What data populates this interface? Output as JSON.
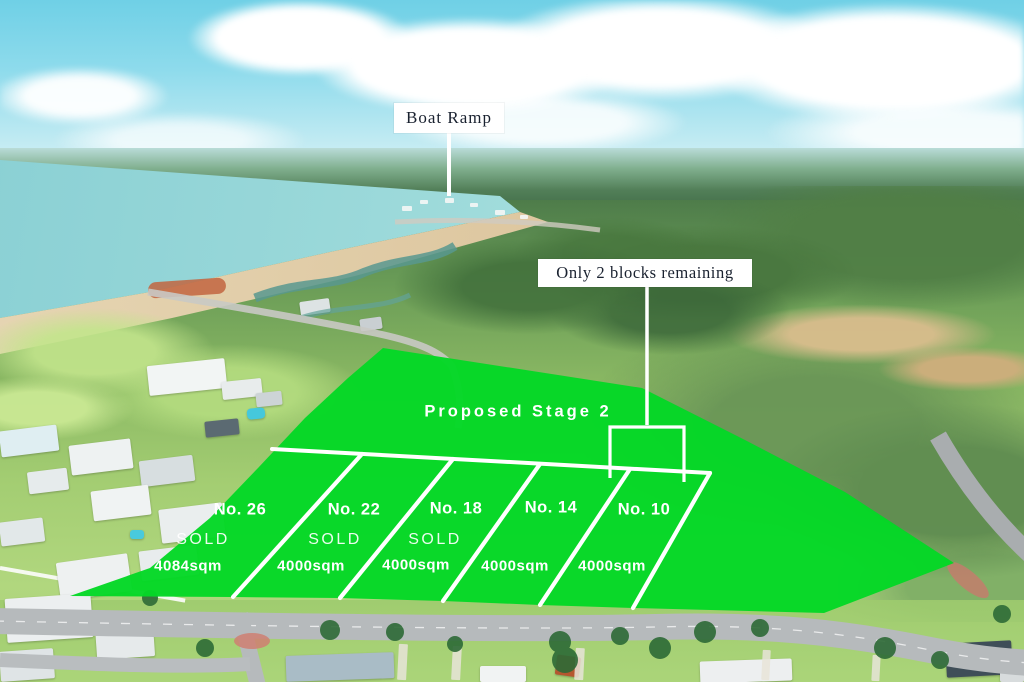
{
  "image": {
    "description": "Aerial drone photo of a coastal residential land estate with a green site-plan overlay"
  },
  "colors": {
    "overlay_green": "#04d826",
    "boundary_line_white": "#ffffff",
    "callout_background": "#ffffff",
    "callout_text": "#1a2230",
    "overlay_label_text": "#ffffff"
  },
  "callouts": {
    "boat_ramp": "Boat Ramp",
    "remaining": "Only 2 blocks remaining"
  },
  "stage": {
    "label": "Proposed Stage 2"
  },
  "lots": [
    {
      "number": "No. 26",
      "status": "SOLD",
      "area": "4084sqm"
    },
    {
      "number": "No. 22",
      "status": "SOLD",
      "area": "4000sqm"
    },
    {
      "number": "No. 18",
      "status": "SOLD",
      "area": "4000sqm"
    },
    {
      "number": "No. 14",
      "status": "",
      "area": "4000sqm"
    },
    {
      "number": "No. 10",
      "status": "",
      "area": "4000sqm"
    }
  ]
}
